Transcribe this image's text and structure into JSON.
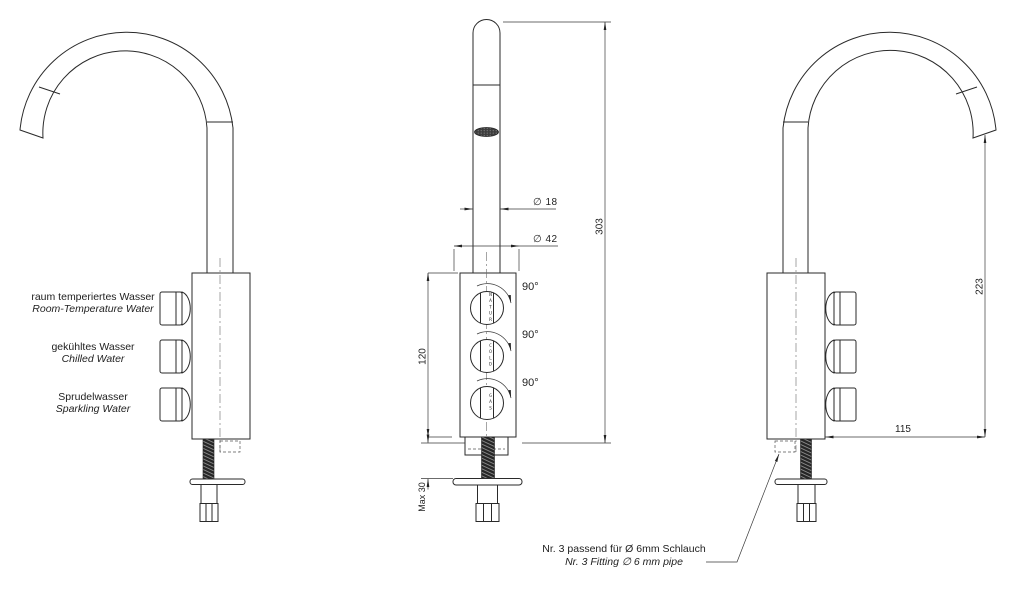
{
  "drawing": {
    "left_view": {
      "labels": [
        {
          "de": "raum temperiertes Wasser",
          "en": "Room-Temperature Water"
        },
        {
          "de": "gekühltes Wasser",
          "en": "Chilled Water"
        },
        {
          "de": "Sprudelwasser",
          "en": "Sparkling Water"
        }
      ]
    },
    "front_view": {
      "knobs": [
        {
          "label": "NATUR",
          "rotation": "90°"
        },
        {
          "label": "COLD",
          "rotation": "90°"
        },
        {
          "label": "GAS",
          "rotation": "90°"
        }
      ],
      "dims": {
        "spout_dia": "∅ 18",
        "base_dia": "∅ 42",
        "total_height": "303",
        "body_height": "120",
        "max_counter": "Max 30"
      }
    },
    "right_view": {
      "dims": {
        "outlet_height": "223",
        "reach": "115"
      },
      "note_de": "Nr. 3 passend für Ø 6mm Schlauch",
      "note_en": "Nr. 3 Fitting ∅ 6 mm pipe"
    }
  }
}
